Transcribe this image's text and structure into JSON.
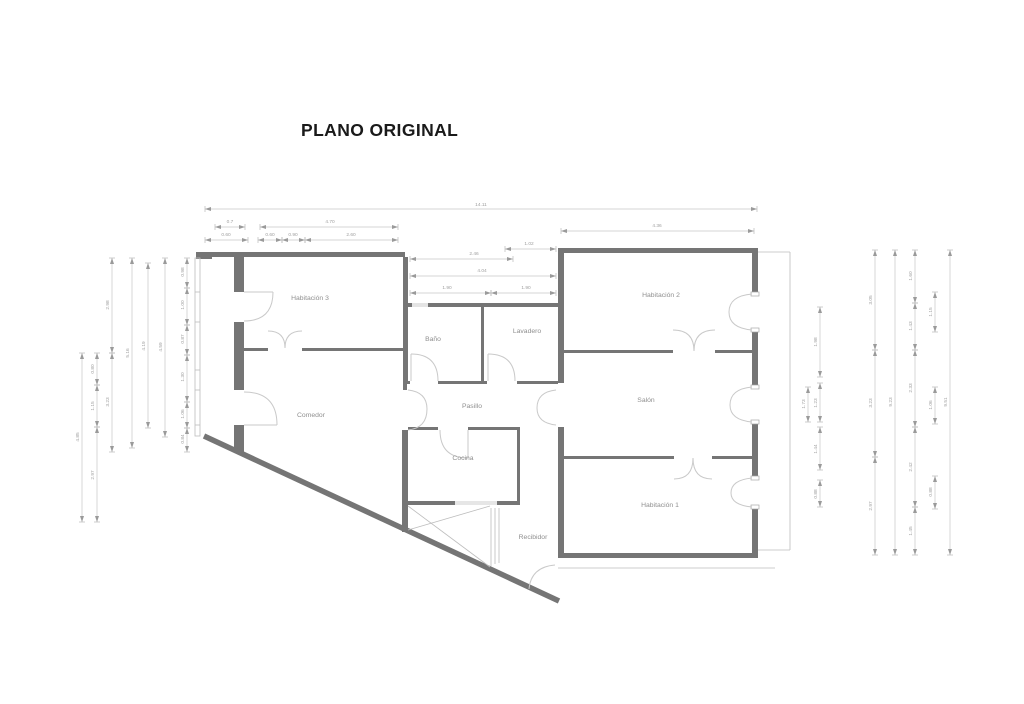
{
  "title": "PLANO ORIGINAL",
  "plan_name": "floor-plan-original",
  "rooms": [
    {
      "name": "Habitación 3",
      "x": 310,
      "y": 300
    },
    {
      "name": "Baño",
      "x": 433,
      "y": 341
    },
    {
      "name": "Lavadero",
      "x": 527,
      "y": 333
    },
    {
      "name": "Habitación 2",
      "x": 661,
      "y": 297
    },
    {
      "name": "Comedor",
      "x": 311,
      "y": 417
    },
    {
      "name": "Pasillo",
      "x": 472,
      "y": 408
    },
    {
      "name": "Salón",
      "x": 646,
      "y": 402
    },
    {
      "name": "Cocina",
      "x": 463,
      "y": 460
    },
    {
      "name": "Habitación 1",
      "x": 660,
      "y": 507
    },
    {
      "name": "Recibidor",
      "x": 533,
      "y": 539
    }
  ],
  "dimensions": [
    {
      "o": "h",
      "pos": 209,
      "from": 205,
      "to": 757,
      "label": "14.11",
      "lx": 481,
      "ly": 206
    },
    {
      "o": "h",
      "pos": 227,
      "from": 215,
      "to": 245,
      "label": "0.7",
      "lx": 230,
      "ly": 223
    },
    {
      "o": "h",
      "pos": 227,
      "from": 260,
      "to": 398,
      "label": "4.70",
      "lx": 330,
      "ly": 223
    },
    {
      "o": "h",
      "pos": 231,
      "from": 561,
      "to": 754,
      "label": "4.36",
      "lx": 657,
      "ly": 227
    },
    {
      "o": "h",
      "pos": 240,
      "from": 205,
      "to": 248,
      "label": "0.60",
      "lx": 226,
      "ly": 236
    },
    {
      "o": "h",
      "pos": 240,
      "from": 258,
      "to": 282,
      "label": "0.60",
      "lx": 270,
      "ly": 236
    },
    {
      "o": "h",
      "pos": 240,
      "from": 282,
      "to": 305,
      "label": "0.90",
      "lx": 293,
      "ly": 236
    },
    {
      "o": "h",
      "pos": 240,
      "from": 305,
      "to": 398,
      "label": "2.60",
      "lx": 351,
      "ly": 236
    },
    {
      "o": "h",
      "pos": 249,
      "from": 505,
      "to": 556,
      "label": "1.02",
      "lx": 529,
      "ly": 245
    },
    {
      "o": "h",
      "pos": 259,
      "from": 410,
      "to": 513,
      "label": "2.46",
      "lx": 474,
      "ly": 255
    },
    {
      "o": "h",
      "pos": 276,
      "from": 410,
      "to": 556,
      "label": "4.04",
      "lx": 482,
      "ly": 272
    },
    {
      "o": "h",
      "pos": 293,
      "from": 410,
      "to": 491,
      "label": "1.90",
      "lx": 447,
      "ly": 289
    },
    {
      "o": "h",
      "pos": 293,
      "from": 491,
      "to": 556,
      "label": "1.90",
      "lx": 526,
      "ly": 289
    },
    {
      "o": "v",
      "pos": 82,
      "from": 353,
      "to": 522,
      "label": "4.85",
      "lx": 79,
      "ly": 437
    },
    {
      "o": "v",
      "pos": 97,
      "from": 353,
      "to": 385,
      "label": "0.80",
      "lx": 94,
      "ly": 369
    },
    {
      "o": "v",
      "pos": 97,
      "from": 385,
      "to": 427,
      "label": "1.15",
      "lx": 94,
      "ly": 406
    },
    {
      "o": "v",
      "pos": 97,
      "from": 427,
      "to": 522,
      "label": "2.97",
      "lx": 94,
      "ly": 475
    },
    {
      "o": "v",
      "pos": 112,
      "from": 258,
      "to": 353,
      "label": "2.98",
      "lx": 109,
      "ly": 305
    },
    {
      "o": "v",
      "pos": 112,
      "from": 353,
      "to": 452,
      "label": "3.23",
      "lx": 109,
      "ly": 402
    },
    {
      "o": "v",
      "pos": 132,
      "from": 258,
      "to": 448,
      "label": "5.16",
      "lx": 129,
      "ly": 353
    },
    {
      "o": "v",
      "pos": 148,
      "from": 263,
      "to": 428,
      "label": "4.19",
      "lx": 145,
      "ly": 346
    },
    {
      "o": "v",
      "pos": 165,
      "from": 258,
      "to": 437,
      "label": "4.59",
      "lx": 162,
      "ly": 347
    },
    {
      "o": "v",
      "pos": 187,
      "from": 258,
      "to": 288,
      "label": "0.98",
      "lx": 184,
      "ly": 272
    },
    {
      "o": "v",
      "pos": 187,
      "from": 288,
      "to": 325,
      "label": "1.00",
      "lx": 184,
      "ly": 305
    },
    {
      "o": "v",
      "pos": 187,
      "from": 325,
      "to": 355,
      "label": "0.87",
      "lx": 184,
      "ly": 339
    },
    {
      "o": "v",
      "pos": 187,
      "from": 355,
      "to": 402,
      "label": "1.30",
      "lx": 184,
      "ly": 377
    },
    {
      "o": "v",
      "pos": 187,
      "from": 402,
      "to": 428,
      "label": "1.06",
      "lx": 184,
      "ly": 414
    },
    {
      "o": "v",
      "pos": 187,
      "from": 428,
      "to": 452,
      "label": "0.84",
      "lx": 184,
      "ly": 439
    },
    {
      "o": "v",
      "pos": 808,
      "from": 387,
      "to": 422,
      "label": "1.73",
      "lx": 805,
      "ly": 404
    },
    {
      "o": "v",
      "pos": 820,
      "from": 307,
      "to": 377,
      "label": "1.98",
      "lx": 817,
      "ly": 342
    },
    {
      "o": "v",
      "pos": 820,
      "from": 383,
      "to": 422,
      "label": "1.23",
      "lx": 817,
      "ly": 403
    },
    {
      "o": "v",
      "pos": 820,
      "from": 427,
      "to": 470,
      "label": "1.44",
      "lx": 817,
      "ly": 449
    },
    {
      "o": "v",
      "pos": 820,
      "from": 480,
      "to": 507,
      "label": "0.88",
      "lx": 817,
      "ly": 494
    },
    {
      "o": "v",
      "pos": 875,
      "from": 250,
      "to": 350,
      "label": "3.05",
      "lx": 872,
      "ly": 300
    },
    {
      "o": "v",
      "pos": 875,
      "from": 350,
      "to": 457,
      "label": "3.23",
      "lx": 872,
      "ly": 403
    },
    {
      "o": "v",
      "pos": 875,
      "from": 457,
      "to": 555,
      "label": "2.97",
      "lx": 872,
      "ly": 506
    },
    {
      "o": "v",
      "pos": 895,
      "from": 250,
      "to": 555,
      "label": "9.23",
      "lx": 892,
      "ly": 402
    },
    {
      "o": "v",
      "pos": 915,
      "from": 250,
      "to": 303,
      "label": "1.60",
      "lx": 912,
      "ly": 276
    },
    {
      "o": "v",
      "pos": 915,
      "from": 303,
      "to": 350,
      "label": "1.43",
      "lx": 912,
      "ly": 326
    },
    {
      "o": "v",
      "pos": 915,
      "from": 350,
      "to": 427,
      "label": "2.33",
      "lx": 912,
      "ly": 388
    },
    {
      "o": "v",
      "pos": 915,
      "from": 427,
      "to": 507,
      "label": "2.42",
      "lx": 912,
      "ly": 467
    },
    {
      "o": "v",
      "pos": 915,
      "from": 507,
      "to": 555,
      "label": "1.45",
      "lx": 912,
      "ly": 531
    },
    {
      "o": "v",
      "pos": 935,
      "from": 292,
      "to": 332,
      "label": "1.15",
      "lx": 932,
      "ly": 312
    },
    {
      "o": "v",
      "pos": 935,
      "from": 387,
      "to": 424,
      "label": "1.06",
      "lx": 932,
      "ly": 405
    },
    {
      "o": "v",
      "pos": 935,
      "from": 476,
      "to": 509,
      "label": "0.88",
      "lx": 932,
      "ly": 492
    },
    {
      "o": "v",
      "pos": 950,
      "from": 250,
      "to": 555,
      "label": "9.51",
      "lx": 947,
      "ly": 402
    }
  ],
  "colors": {
    "wall": "#757575",
    "thin_line": "#bdbdbd",
    "door_arc": "#c9c9c9",
    "dim_line": "#c6c6c6",
    "dim_text": "#a0a0a0",
    "room_text": "#8f8f8f",
    "title_text": "#1a1a1a"
  }
}
